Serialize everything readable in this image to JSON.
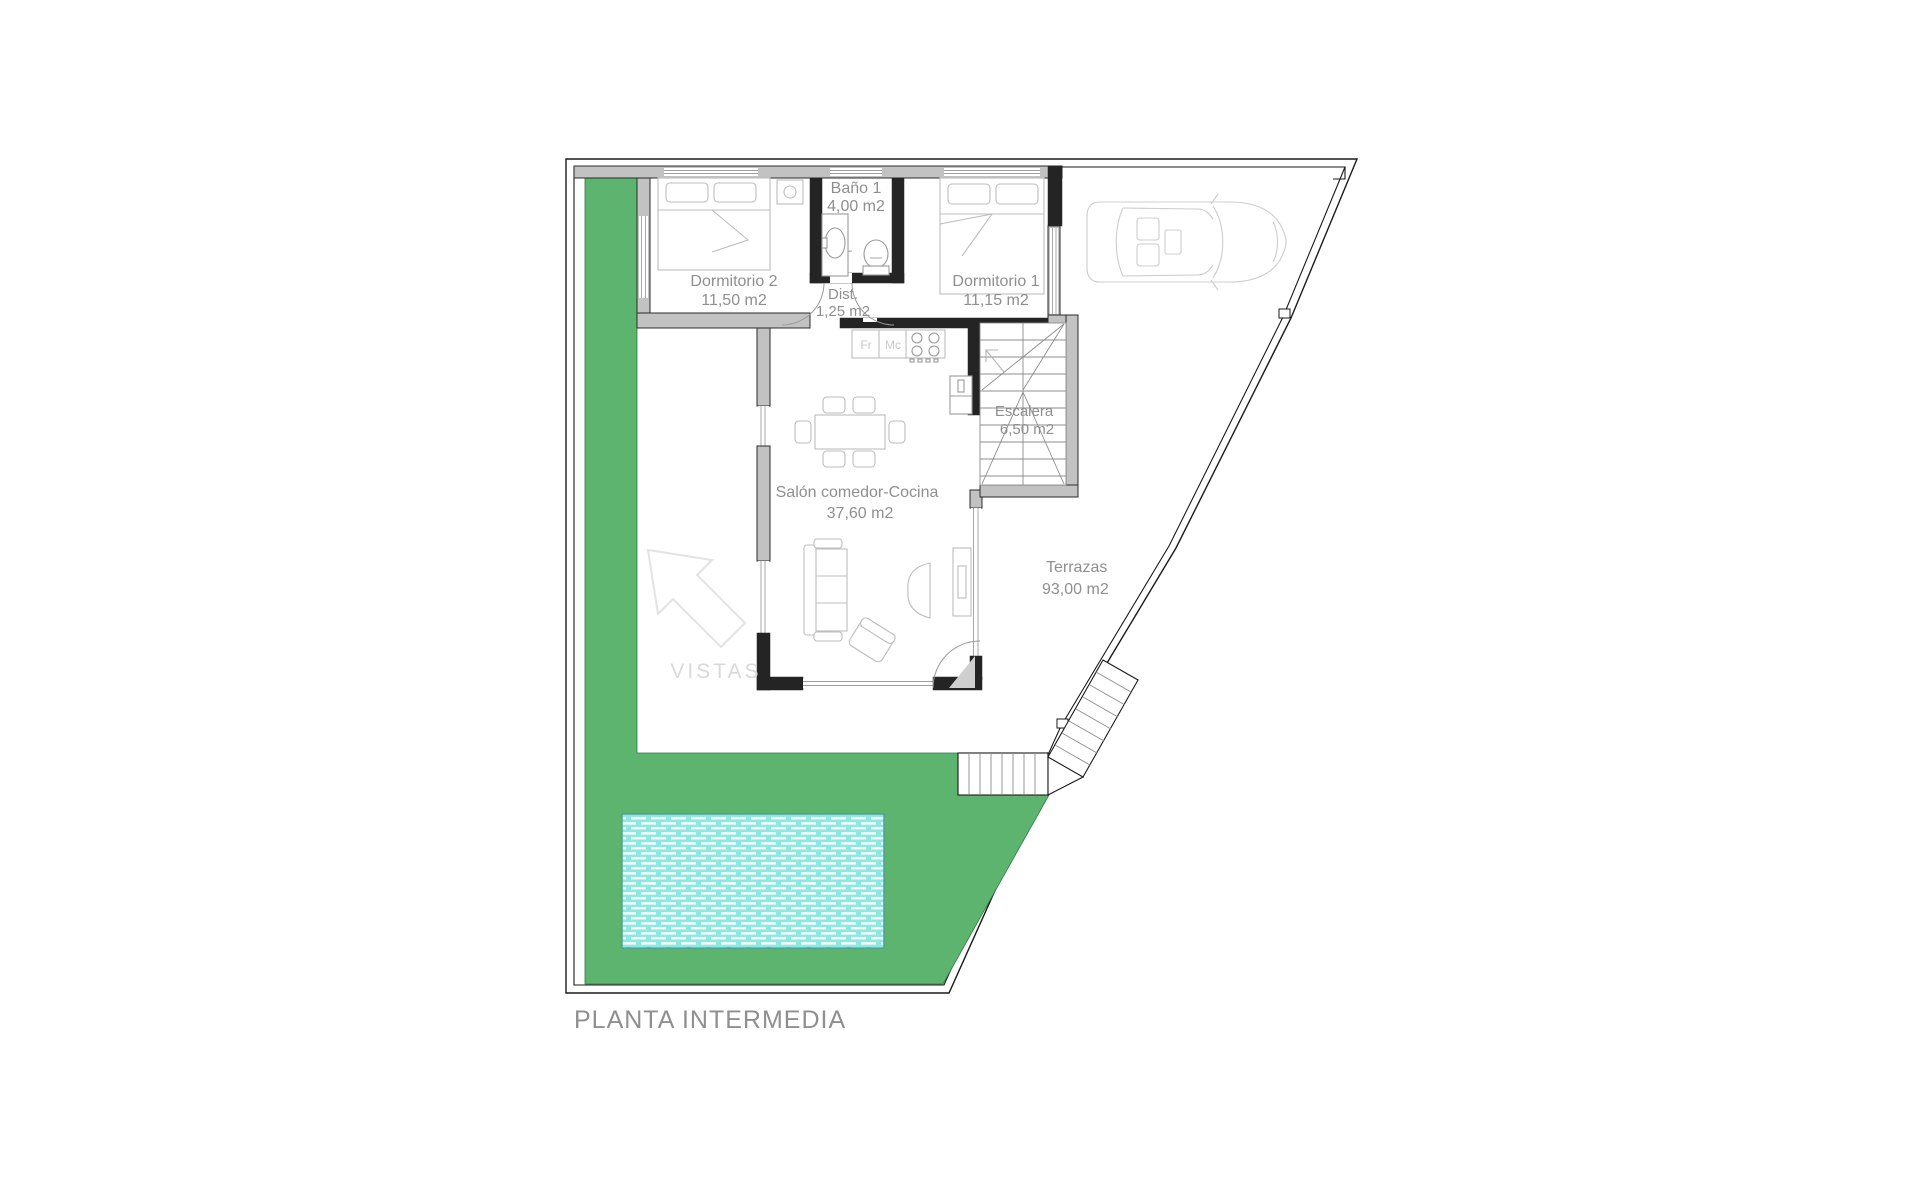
{
  "title": "PLANTA INTERMEDIA",
  "colors": {
    "garden": "#5CB46E",
    "garden_edge": "#2F7A45",
    "pool": "#8DE8E1",
    "pool_edge": "#4D9D99",
    "wall_gray": "#C2C2C2",
    "wall_dark": "#242424",
    "boundary": "#1A1A1A",
    "furniture": "#BDBDBD",
    "label_text": "#8F8F8F",
    "faint_text": "#D9D9D9"
  },
  "rooms": {
    "dormitorio2": {
      "name": "Dormitorio 2",
      "area": "11,50 m2"
    },
    "bano1": {
      "name": "Baño 1",
      "area": "4,00 m2"
    },
    "dormitorio1": {
      "name": "Dormitorio 1",
      "area": "11,15 m2"
    },
    "dist": {
      "name": "Dist.",
      "area": "1,25 m2"
    },
    "salon": {
      "name": "Salón comedor-Cocina",
      "area": "37,60 m2"
    },
    "escalera": {
      "name": "Escalera",
      "area": "6,50 m2"
    },
    "terrazas": {
      "name": "Terrazas",
      "area": "93,00 m2"
    }
  },
  "kitchen": {
    "fridge_label": "Fr",
    "micro_label": "Mc"
  },
  "annotations": {
    "vistas": "VISTAS"
  }
}
